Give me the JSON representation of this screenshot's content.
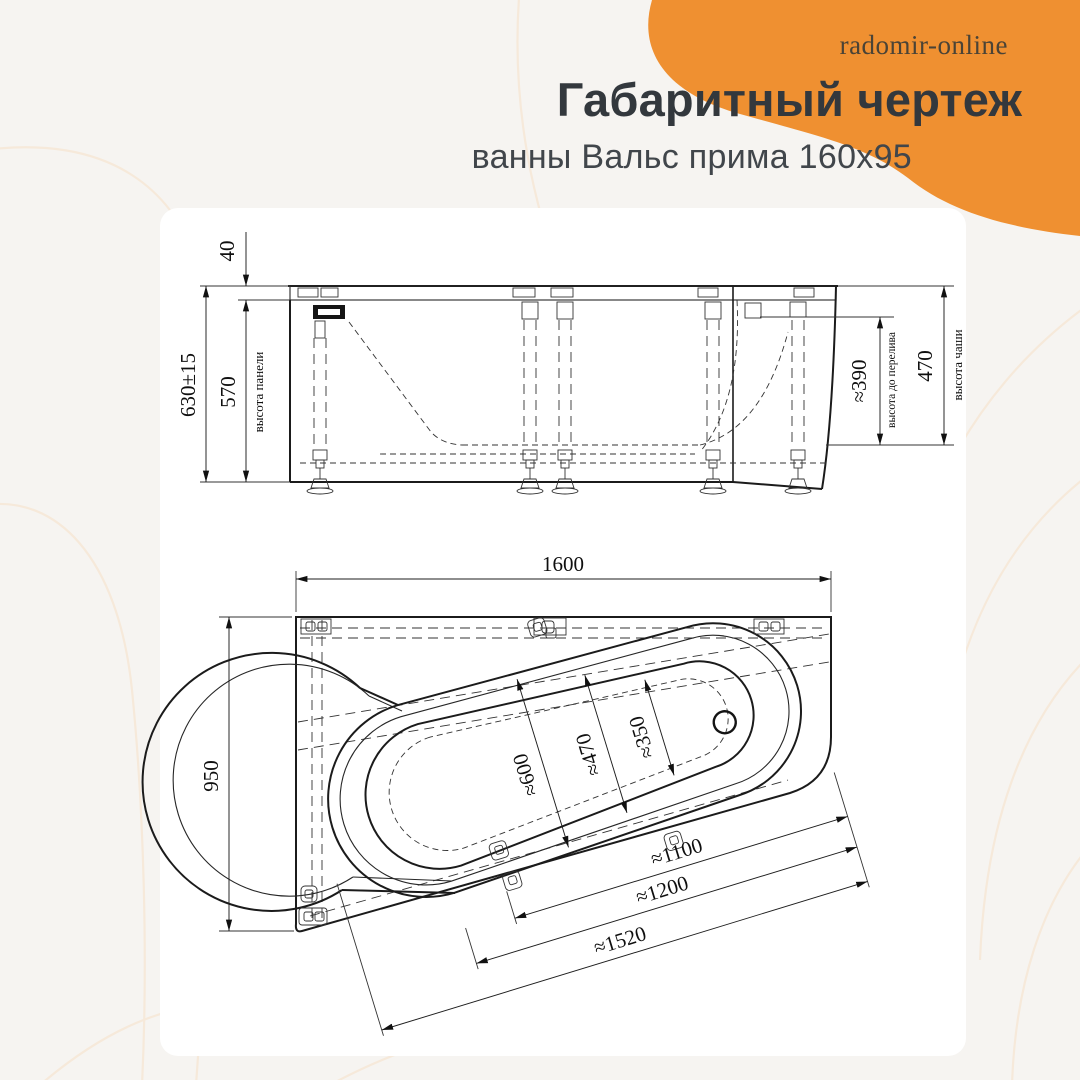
{
  "header": {
    "brand": "radomir-online",
    "title": "Габаритный чертеж",
    "subtitle": "ванны Вальс прима 160х95"
  },
  "colors": {
    "accent": "#EF9031",
    "background": "#F6F4F1",
    "panel": "#FFFFFF",
    "line": "#1B1B1B",
    "wave": "#F6E9DA"
  },
  "side_view": {
    "rim_offset": "40",
    "total_height": "630±15",
    "panel_height": "570",
    "panel_height_caption": "высота панели",
    "overflow_height": "≈390",
    "overflow_caption": "высота до перелива",
    "bowl_height": "470",
    "bowl_height_caption": "высота чаши"
  },
  "top_view": {
    "length": "1600",
    "width": "950",
    "bowl_width_head": "≈600",
    "bowl_width_mid": "≈470",
    "bowl_width_foot": "≈350",
    "length_inner": "≈1100",
    "length_bowl": "≈1200",
    "length_overall": "≈1520"
  }
}
